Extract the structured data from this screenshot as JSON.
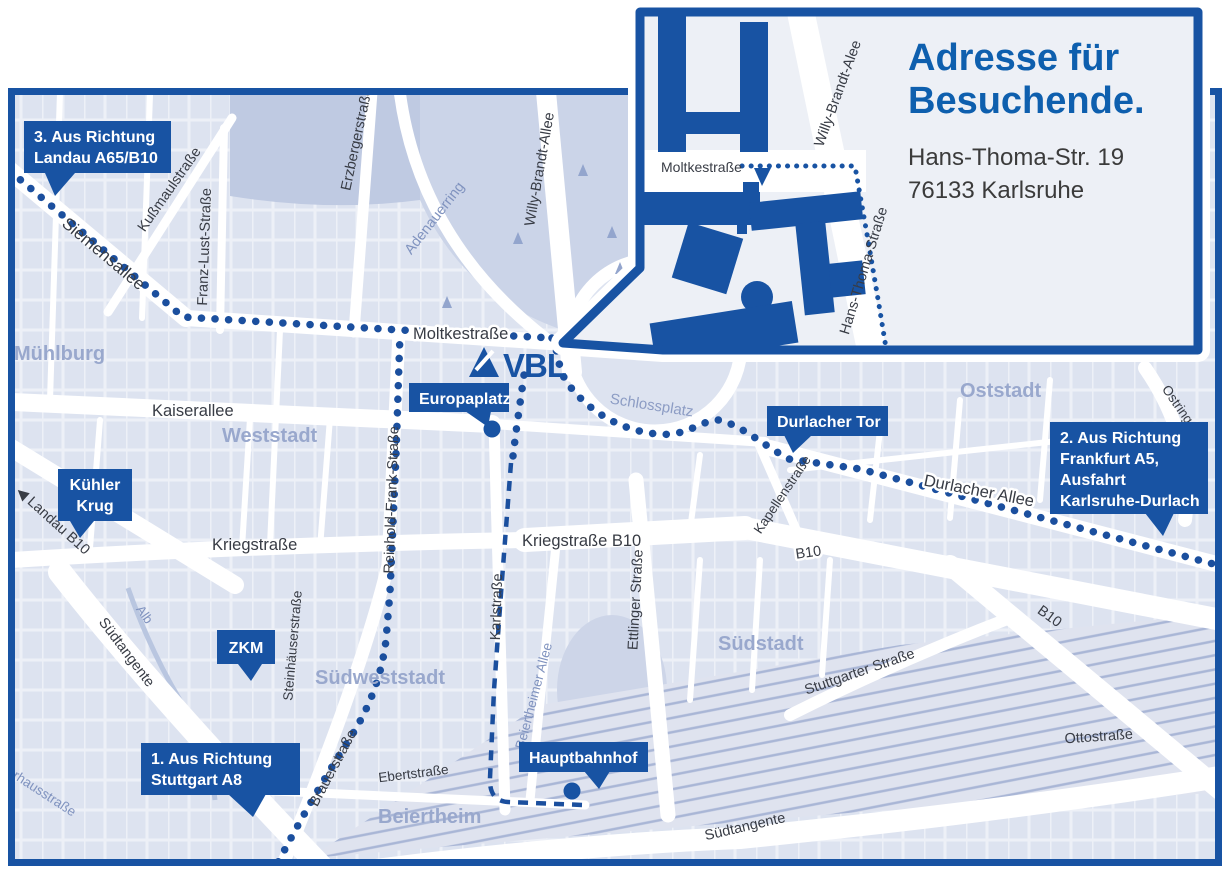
{
  "colors": {
    "accent": "#1853a3",
    "title_blue": "#0e5fae",
    "route_blue": "#1b4f9e",
    "map_bg": "#dde3f0",
    "district_label": "#99a8cd"
  },
  "logo": {
    "text": "VBL"
  },
  "inset": {
    "title_lines": [
      "Adresse für",
      "Besuchende."
    ],
    "address_lines": [
      "Hans-Thoma-Str. 19",
      "76133 Karlsruhe"
    ],
    "streets": {
      "moltkestrasse": "Moltkestraße",
      "willy_brandt": "Willy-Brandt-Alee",
      "hans_thoma": "Hans-Thoma-Straße"
    }
  },
  "map": {
    "callouts": [
      {
        "id": "landau",
        "lines": [
          "3. Aus Richtung",
          "Landau A65/B10"
        ]
      },
      {
        "id": "kuehler-krug",
        "lines": [
          "Kühler",
          "Krug"
        ]
      },
      {
        "id": "zkm",
        "lines": [
          "ZKM"
        ]
      },
      {
        "id": "stuttgart",
        "lines": [
          "1. Aus Richtung",
          "Stuttgart A8"
        ]
      },
      {
        "id": "europaplatz",
        "lines": [
          "Europaplatz"
        ]
      },
      {
        "id": "durlacher-tor",
        "lines": [
          "Durlacher Tor"
        ]
      },
      {
        "id": "frankfurt",
        "lines": [
          "2. Aus Richtung",
          "Frankfurt A5,",
          "Ausfahrt",
          "Karlsruhe-Durlach"
        ]
      },
      {
        "id": "hauptbahnhof",
        "lines": [
          "Hauptbahnhof"
        ]
      }
    ],
    "districts": [
      "Mühlburg",
      "Weststadt",
      "Oststadt",
      "Südstadt",
      "Südweststadt",
      "Beiertheim"
    ],
    "streets": [
      "Siemensallee",
      "Kußmaulstraße",
      "Franz-Lust-Straße",
      "Erzbergerstraße",
      "Adenauerring",
      "Willy-Brandt-Allee",
      "Moltkestraße",
      "Kaiserallee",
      "Reinhold-Frank-Straße",
      "Kriegstraße",
      "Kriegstraße B10",
      "Karlstraße",
      "Ettlinger Straße",
      "Kapellenstraße",
      "Durlacher Allee",
      "Ostring",
      "Stuttgarter Straße",
      "Ottostraße",
      "Ebertstraße",
      "Beiertheimer Allee",
      "Steinhäuserstraße",
      "Brauerstraße",
      "Pulverhausstraße",
      "Südtangente",
      "Südtangente",
      "Alb",
      "Schlossplatz",
      "◀ Landau B10",
      "B10",
      "B10"
    ]
  }
}
